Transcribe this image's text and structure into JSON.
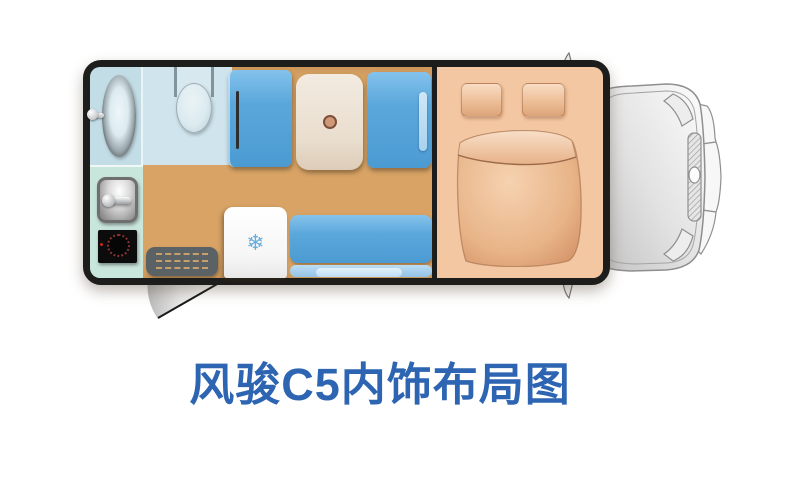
{
  "title": {
    "text": "风骏C5内饰布局图"
  },
  "icons": {
    "snowflake": "❄"
  },
  "colors": {
    "title_blue": "#2d65b2",
    "body_border": "#1d1d1b",
    "floor_tan": "#d8a365",
    "bathroom_blue": "#c3dde6",
    "toilet_room_blue": "#cfe4ec",
    "furniture_blue": "#57a5d9",
    "seat_backrest_blue": "#a9d2ee",
    "table_cream": "#ebe1d5",
    "bed_peach": "#f4c7a3",
    "bedding_salmon": "#dd9a6f",
    "kitchen_mint": "#c9e6dd",
    "doormat_gray": "#5b6265",
    "fridge_white": "#ffffff",
    "snowflake_blue": "#69aede",
    "cab_outline_gray": "#8f8f8f"
  }
}
